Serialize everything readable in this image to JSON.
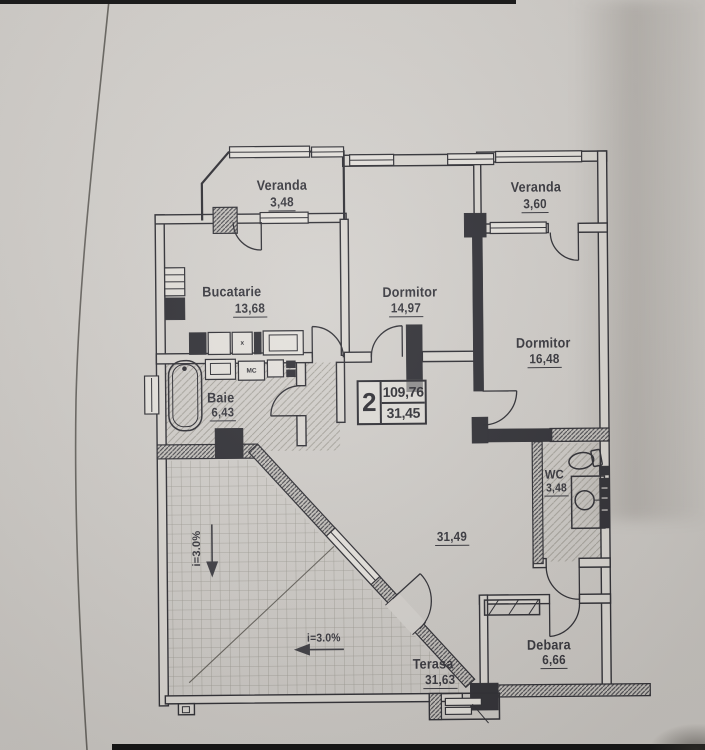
{
  "colors": {
    "paper": "#d3d0cc",
    "ink": "#34343b",
    "wall_dark": "#2e2e34"
  },
  "plan": {
    "unit_info": {
      "rooms_count": "2",
      "area_total": "109,76",
      "area_living": "31,45"
    },
    "rooms": {
      "veranda_nw": {
        "name": "Veranda",
        "area": "3,48"
      },
      "veranda_ne": {
        "name": "Veranda",
        "area": "3,60"
      },
      "bucatarie": {
        "name": "Bucatarie",
        "area": "13,68"
      },
      "dormitor_mic": {
        "name": "Dormitor",
        "area": "14,97"
      },
      "dormitor_mare": {
        "name": "Dormitor",
        "area": "16,48"
      },
      "baie": {
        "name": "Baie",
        "area": "6,43"
      },
      "hol": {
        "area": "31,49"
      },
      "wc": {
        "name": "WC",
        "area": "3,48"
      },
      "debara": {
        "name": "Debara",
        "area": "6,66"
      },
      "terasa": {
        "name": "Terasa",
        "area": "31,63"
      }
    },
    "annotations": {
      "slope_vertical": "i=3.0%",
      "slope_horizontal": "i=3.0%",
      "washing_machine": "MC",
      "kitchen_unit": "x"
    }
  }
}
